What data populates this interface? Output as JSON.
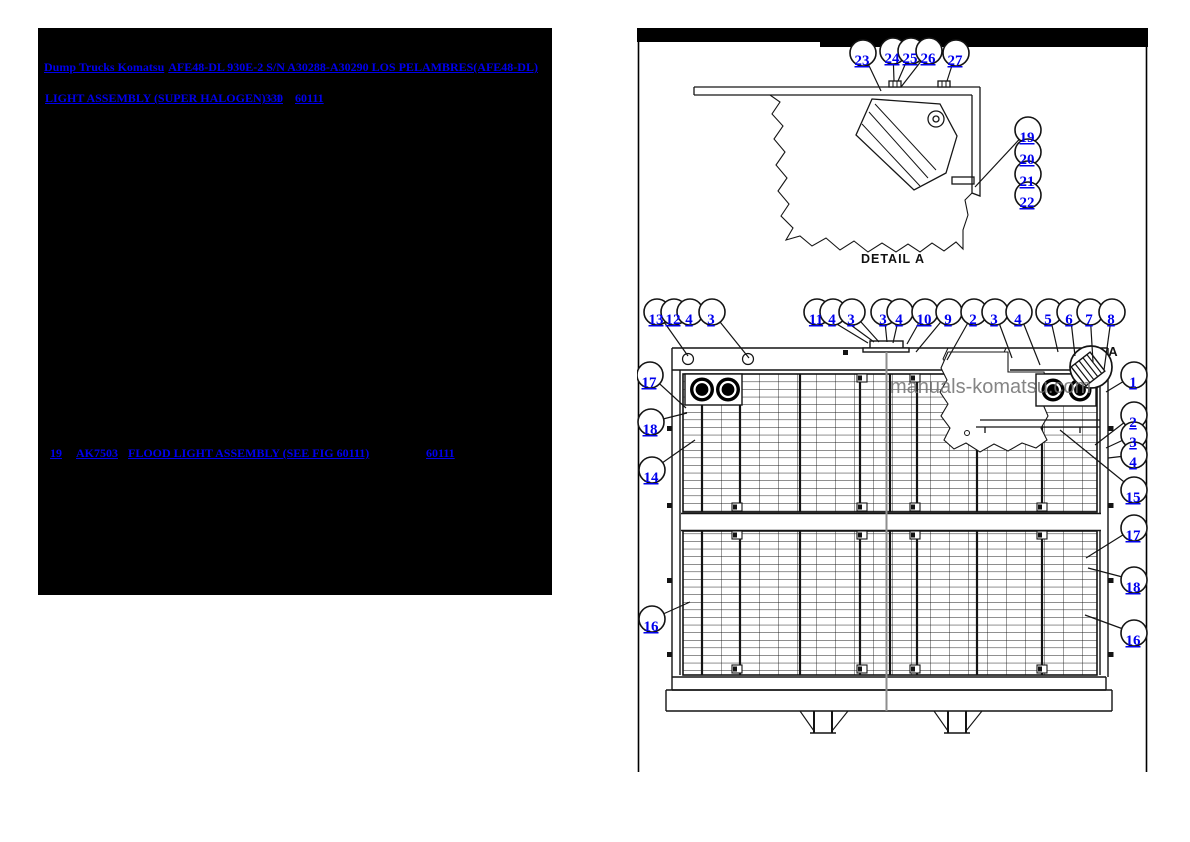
{
  "left_panel": {
    "breadcrumb_links": [
      "Dump Trucks Komatsu",
      "AFE48-DL 930E-2 S/N A30288-A30290 LOS PELAMBRES(AFE48-DL)"
    ],
    "assembly": {
      "title": "LIGHT ASSEMBLY (SUPER HALOGEN) - 1",
      "sheet": "330",
      "figure": "60111"
    },
    "part_row": {
      "item": "19",
      "part_number": "AK7503",
      "description": "FLOOD LIGHT ASSEMBLY (SEE FIG 60111)",
      "qty": "1",
      "figure": "60111"
    }
  },
  "diagram": {
    "detail_label": "DETAIL A",
    "detail_marker_label": "A",
    "watermark": "manuals-komatsu.com",
    "callouts": {
      "detail_top": [
        "23",
        "24",
        "25",
        "26",
        "27"
      ],
      "detail_right": [
        "19",
        "20",
        "21",
        "22"
      ],
      "main_top": [
        "13",
        "12",
        "4",
        "3",
        "11",
        "4",
        "3",
        "3",
        "4",
        "10",
        "9",
        "2",
        "3",
        "4",
        "5",
        "6",
        "7",
        "8"
      ],
      "main_left": [
        "17",
        "18",
        "14",
        "16"
      ],
      "main_right": [
        "1",
        "2",
        "3",
        "4",
        "15",
        "17",
        "18",
        "16"
      ]
    }
  },
  "colors": {
    "link_blue": "#0000ee",
    "panel_background": "#000000",
    "watermark_gray": "#707070"
  }
}
